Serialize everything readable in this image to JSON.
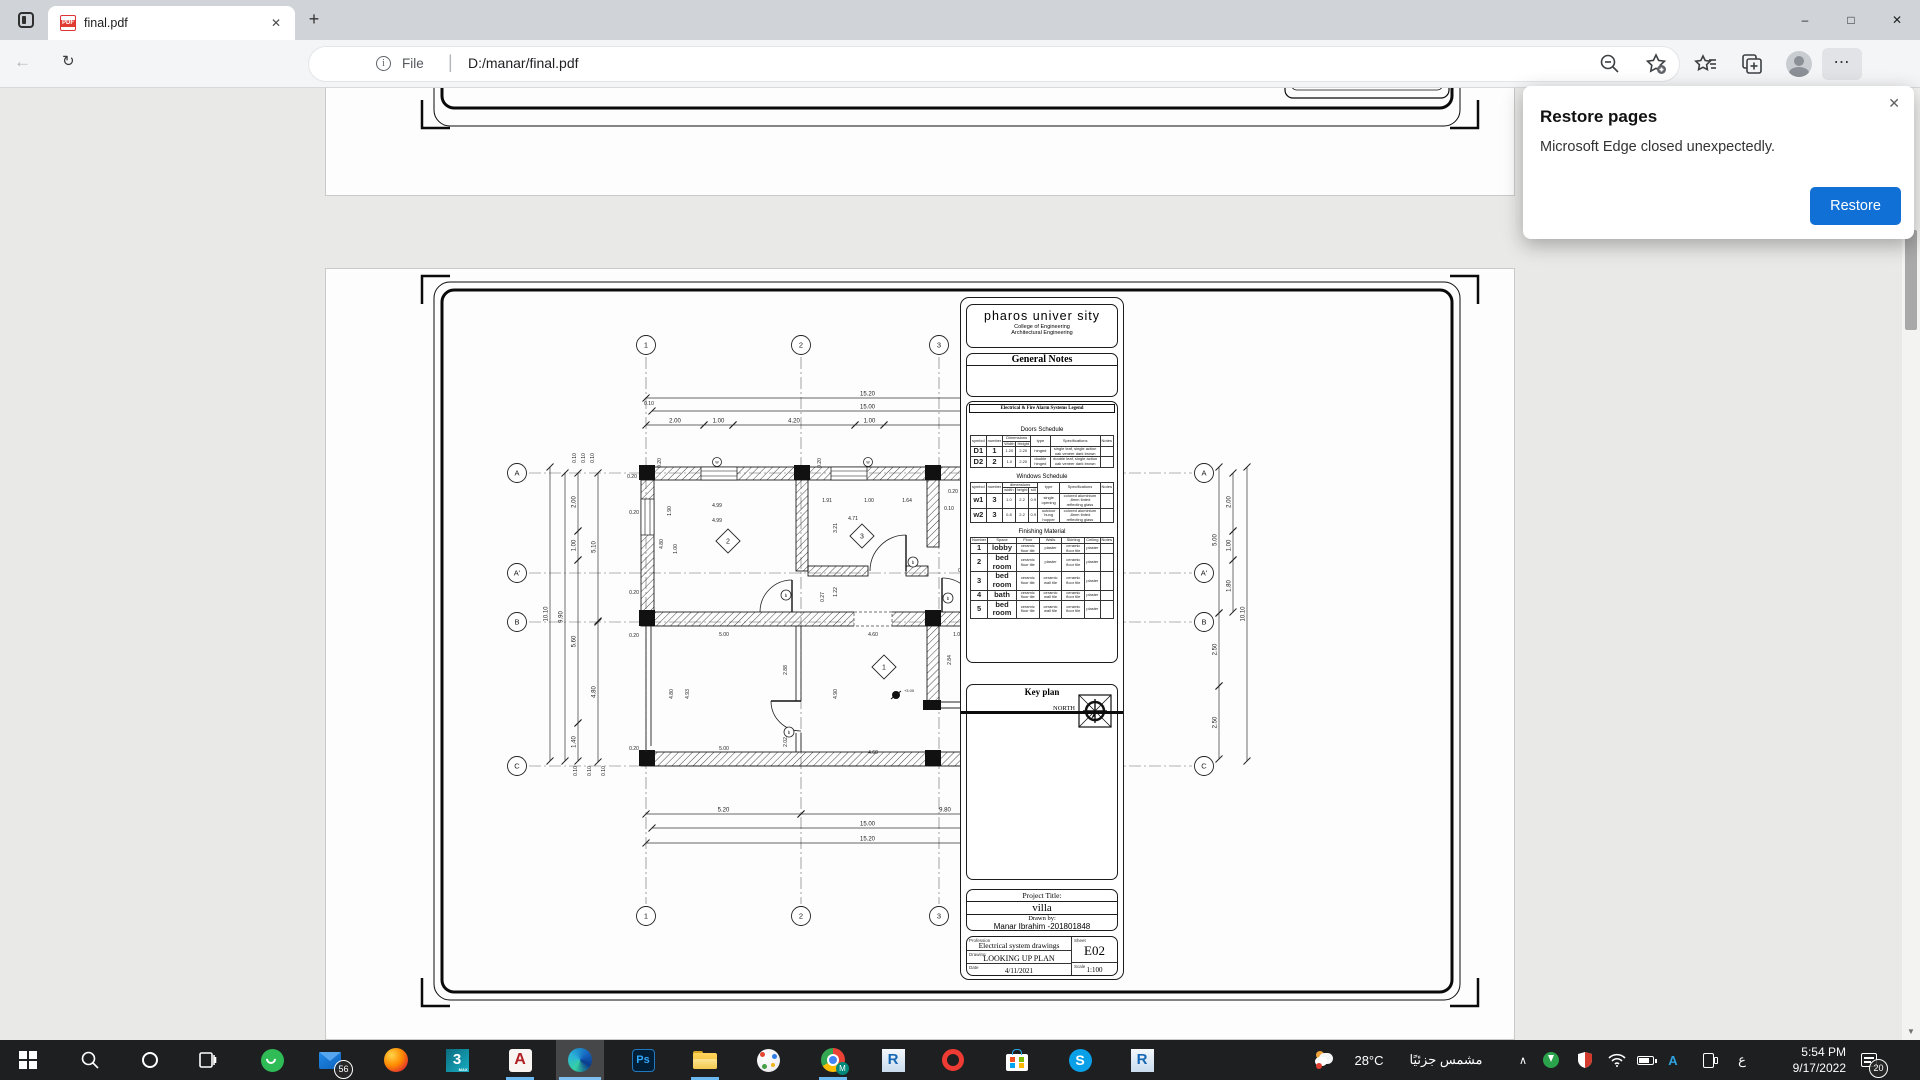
{
  "browser": {
    "tab_title": "final.pdf",
    "address": {
      "prefix": "File",
      "url": "D:/manar/final.pdf"
    },
    "dialog": {
      "title": "Restore pages",
      "message": "Microsoft Edge closed unexpectedly.",
      "button": "Restore"
    }
  },
  "icons": {
    "back": "←",
    "refresh": "↻",
    "newtab": "+",
    "tabclose": "✕",
    "min": "–",
    "max": "□",
    "close": "✕",
    "dots": "⋯",
    "info": "i",
    "dialogclose": "✕",
    "scrollup": "▲",
    "scrolldown": "▼",
    "divider": "|",
    "chevron_up": "∧"
  },
  "sheet": {
    "university": "pharos univer sity",
    "college": "College of Engineering",
    "department": "Architectural Engineering",
    "general_notes_title": "General Notes",
    "legend_title": "Electrical & Fire Alarm Systems Legend",
    "doors": {
      "title": "Doors Schedule",
      "cols": [
        {
          "l": "symbol"
        },
        {
          "l": "number"
        },
        {
          "l": "Dimensions",
          "sub": [
            "Width",
            "Height"
          ]
        },
        {
          "l": "type"
        },
        {
          "l": "Specifications"
        },
        {
          "l": "Notes"
        }
      ],
      "rows": [
        [
          "D1",
          "1",
          "1.20",
          "2.20",
          "hinged",
          "single leaf, single action oak veneer dark brown",
          ""
        ],
        [
          "D2",
          "2",
          "1.0",
          "2.20",
          "double hinged",
          "double leaf, single action oak veneer dark brown",
          ""
        ]
      ]
    },
    "windows": {
      "title": "Windows Schedule",
      "cols": [
        {
          "l": "symbol"
        },
        {
          "l": "number"
        },
        {
          "l": "dimensions",
          "sub": [
            "width",
            "height",
            "sill"
          ]
        },
        {
          "l": "type"
        },
        {
          "l": "Specifications"
        },
        {
          "l": "Notes"
        }
      ],
      "rows": [
        [
          "w1",
          "3",
          "1.0",
          "2.2",
          "0.9",
          "single opening",
          "colored aluminium ,8mm tinted reflecting glass",
          ""
        ],
        [
          "w2",
          "3",
          "0.8",
          "2.2",
          "0.9",
          "outdoor hung hopper",
          "colored aluminium ,8mm tinted reflecting glass",
          ""
        ]
      ]
    },
    "finishing": {
      "title": "Finishing Material",
      "cols": [
        {
          "l": "Number"
        },
        {
          "l": "Space"
        },
        {
          "l": "Floor"
        },
        {
          "l": "Walls"
        },
        {
          "l": "Skirting"
        },
        {
          "l": "Ceiling"
        },
        {
          "l": "Notes"
        }
      ],
      "rows": [
        [
          "1",
          "lobby",
          "ceramic floor tile",
          "plaster",
          "ceramic floor tile",
          "plaster",
          ""
        ],
        [
          "2",
          "bed room",
          "ceramic floor tile",
          "plaster",
          "ceramic floor tile",
          "plaster",
          ""
        ],
        [
          "3",
          "bed room",
          "ceramic floor tile",
          "ceramic wall tile",
          "ceramic floor tile",
          "plaster",
          ""
        ],
        [
          "4",
          "bath",
          "ceramic floor tile",
          "ceramic wall tile",
          "ceramic floor tile",
          "plaster",
          ""
        ],
        [
          "5",
          "bed room",
          "ceramic floor tile",
          "ceramic wall tile",
          "ceramic floor tile",
          "plaster",
          ""
        ]
      ]
    },
    "key_plan_title": "Key plan",
    "north_label": "NORTH",
    "project_title_label": "Project Title:",
    "project_title": "villa",
    "drawn_by_label": "Drawn by:",
    "drawn_by": "Manar Ibrahim -201801848",
    "profession_label": "Profession",
    "profession": "Electrical system drawings",
    "sheet_label": "Sheet",
    "sheet_no": "E02",
    "drawing_label": "Drawing",
    "drawing": "LOOKING UP PLAN",
    "date_label": "Date",
    "date": "4/11/2021",
    "scale_label": "Scale",
    "scale": "1:100"
  },
  "plan": {
    "vgrids": [
      {
        "x": 645,
        "l": "1"
      },
      {
        "x": 800,
        "l": "2"
      },
      {
        "x": 938,
        "l": "3"
      },
      {
        "x": 1088,
        "l": "4"
      }
    ],
    "hgrids": [
      {
        "y": 472,
        "l": "A"
      },
      {
        "y": 572,
        "l": "A'"
      },
      {
        "y": 621,
        "l": "B"
      },
      {
        "y": 765,
        "l": "C"
      }
    ],
    "dims": [
      {
        "x1": 645,
        "y1": 397,
        "x2": 1088,
        "y2": 397,
        "t": "15.20"
      },
      {
        "x1": 651,
        "y1": 410,
        "x2": 1082,
        "y2": 410,
        "t": "15.00"
      },
      {
        "x1": 645,
        "y1": 424,
        "x2": 703,
        "y2": 424,
        "t": "2.00"
      },
      {
        "x1": 703,
        "y1": 424,
        "x2": 732,
        "y2": 424,
        "t": "1.00"
      },
      {
        "x1": 732,
        "y1": 424,
        "x2": 854,
        "y2": 424,
        "t": "4.20"
      },
      {
        "x1": 854,
        "y1": 424,
        "x2": 883,
        "y2": 424,
        "t": "1.00"
      },
      {
        "x1": 883,
        "y1": 424,
        "x2": 1082,
        "y2": 424,
        "t": "6.90"
      },
      {
        "x1": 645,
        "y1": 813,
        "x2": 800,
        "y2": 813,
        "t": "5.20"
      },
      {
        "x1": 800,
        "y1": 813,
        "x2": 1088,
        "y2": 813,
        "t": "9.80"
      },
      {
        "x1": 651,
        "y1": 827,
        "x2": 1082,
        "y2": 827,
        "t": "15.00"
      },
      {
        "x1": 645,
        "y1": 842,
        "x2": 1088,
        "y2": 842,
        "t": "15.20"
      },
      {
        "x1": 549,
        "y1": 466,
        "x2": 549,
        "y2": 760,
        "t": "10.10"
      },
      {
        "x1": 564,
        "y1": 472,
        "x2": 564,
        "y2": 760,
        "t": "9.90"
      },
      {
        "x1": 577,
        "y1": 472,
        "x2": 577,
        "y2": 530,
        "t": "2.00"
      },
      {
        "x1": 577,
        "y1": 530,
        "x2": 577,
        "y2": 559,
        "t": "1.00"
      },
      {
        "x1": 577,
        "y1": 559,
        "x2": 577,
        "y2": 722,
        "t": "5.60"
      },
      {
        "x1": 577,
        "y1": 722,
        "x2": 577,
        "y2": 760,
        "t": "1.40"
      },
      {
        "x1": 597,
        "y1": 472,
        "x2": 597,
        "y2": 620,
        "t": "5.10"
      },
      {
        "x1": 597,
        "y1": 621,
        "x2": 597,
        "y2": 761,
        "t": "4.80"
      },
      {
        "x1": 1218,
        "y1": 466,
        "x2": 1218,
        "y2": 612,
        "t": "5.00"
      },
      {
        "x1": 1218,
        "y1": 612,
        "x2": 1218,
        "y2": 685,
        "t": "2.50"
      },
      {
        "x1": 1218,
        "y1": 685,
        "x2": 1218,
        "y2": 758,
        "t": "2.50"
      },
      {
        "x1": 1232,
        "y1": 472,
        "x2": 1232,
        "y2": 530,
        "t": "2.00"
      },
      {
        "x1": 1232,
        "y1": 530,
        "x2": 1232,
        "y2": 559,
        "t": "1.00"
      },
      {
        "x1": 1232,
        "y1": 559,
        "x2": 1232,
        "y2": 611,
        "t": "1.80"
      },
      {
        "x1": 1246,
        "y1": 466,
        "x2": 1246,
        "y2": 760,
        "t": "10.10"
      }
    ],
    "labels": [
      [
        716,
        506,
        "4.99"
      ],
      [
        716,
        521,
        "4.99"
      ],
      [
        826,
        501,
        "1.91"
      ],
      [
        868,
        501,
        "1.00"
      ],
      [
        906,
        501,
        "1.64"
      ],
      [
        852,
        519,
        "4.71"
      ],
      [
        1012,
        501,
        "4.86"
      ],
      [
        1012,
        519,
        "4.90"
      ],
      [
        670,
        510,
        "1.90",
        1
      ],
      [
        662,
        543,
        "4.80",
        1
      ],
      [
        676,
        548,
        "1.00",
        1
      ],
      [
        836,
        527,
        "3.21",
        1
      ],
      [
        968,
        527,
        "3.31",
        1
      ],
      [
        1014,
        549,
        "4.00",
        1
      ],
      [
        1056,
        546,
        "5.00",
        1
      ],
      [
        1098,
        549,
        "1.00",
        1
      ],
      [
        836,
        591,
        "1.22",
        1
      ],
      [
        823,
        596,
        "0.27",
        1
      ],
      [
        723,
        635,
        "5.00"
      ],
      [
        872,
        635,
        "4.60"
      ],
      [
        957,
        635,
        "1.00"
      ],
      [
        1032,
        633,
        "3.70"
      ],
      [
        996,
        643,
        "0.10"
      ],
      [
        950,
        659,
        "2.84",
        1
      ],
      [
        1010,
        652,
        "1.50",
        1
      ],
      [
        1054,
        660,
        "2.50",
        1
      ],
      [
        1072,
        660,
        "2.50",
        1
      ],
      [
        786,
        669,
        "2.88",
        1
      ],
      [
        786,
        741,
        "2.02",
        1
      ],
      [
        688,
        693,
        "4.93",
        1
      ],
      [
        672,
        693,
        "4.80",
        1
      ],
      [
        836,
        693,
        "4.90",
        1
      ],
      [
        723,
        749,
        "5.00"
      ],
      [
        872,
        753,
        "4.60"
      ],
      [
        1020,
        673,
        "0.94",
        1
      ],
      [
        1031,
        673,
        "0.06",
        1
      ],
      [
        1080,
        711,
        "1.00",
        1
      ],
      [
        1080,
        729,
        "0.60",
        1
      ],
      [
        660,
        462,
        "0.20",
        1
      ],
      [
        820,
        462,
        "0.20",
        1
      ],
      [
        1000,
        462,
        "0.20",
        1
      ],
      [
        575,
        457,
        "0.10",
        1
      ],
      [
        584,
        457,
        "0.10",
        1
      ],
      [
        593,
        457,
        "0.10",
        1
      ],
      [
        648,
        404,
        "0.10"
      ],
      [
        1098,
        404,
        "0.10"
      ],
      [
        1104,
        819,
        "0.13"
      ],
      [
        952,
        492,
        "0.20"
      ],
      [
        948,
        509,
        "0.10"
      ],
      [
        631,
        477,
        "0.20"
      ],
      [
        633,
        513,
        "0.20"
      ],
      [
        633,
        593,
        "0.20"
      ],
      [
        633,
        636,
        "0.20"
      ],
      [
        633,
        749,
        "0.20"
      ],
      [
        1108,
        477,
        "0.20"
      ],
      [
        1108,
        593,
        "0.20"
      ],
      [
        1108,
        636,
        "0.20"
      ],
      [
        1108,
        749,
        "0.20"
      ],
      [
        962,
        571,
        "0.10"
      ],
      [
        975,
        636,
        "0.10"
      ],
      [
        1040,
        646,
        "0.10"
      ],
      [
        576,
        770,
        "0.10",
        1
      ],
      [
        590,
        770,
        "0.10",
        1
      ],
      [
        604,
        770,
        "0.10",
        1
      ]
    ],
    "rooms": [
      [
        727,
        540,
        "2"
      ],
      [
        861,
        535,
        "3"
      ],
      [
        993,
        539,
        "5"
      ],
      [
        883,
        666,
        "1"
      ],
      [
        1029,
        651,
        "4"
      ]
    ],
    "symbols": [
      [
        785,
        594
      ],
      [
        912,
        561
      ],
      [
        947,
        597
      ],
      [
        982,
        684
      ],
      [
        788,
        731
      ]
    ],
    "window_tags": [
      [
        716,
        461
      ],
      [
        867,
        461
      ]
    ],
    "fans": [
      [
        895,
        694,
        "+3.00"
      ],
      [
        1058,
        714,
        ""
      ]
    ]
  },
  "taskbar": {
    "weather_temp": "28°C",
    "weather_desc": "مشمس جزئيًا",
    "mail_badge": "56",
    "notif_badge": "20",
    "language": "ع",
    "time": "5:54 PM",
    "date": "9/17/2022"
  }
}
